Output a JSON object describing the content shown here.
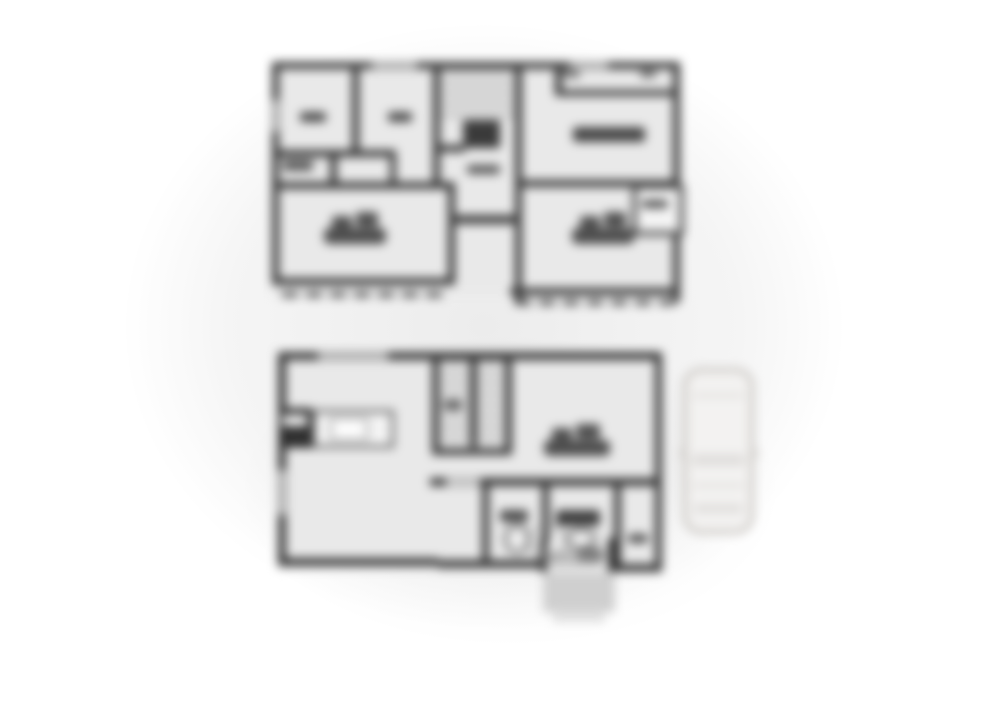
{
  "canvas": {
    "width": 1000,
    "height": 709,
    "description": "Heavily blurred monochrome two-storey house floor plan with a car parked beside the ground floor"
  },
  "colors": {
    "page_bg": "#ffffff",
    "backdrop_gray": "#ebebeb",
    "wall": "#333333",
    "room_fill": "#e9e9e9",
    "furniture": "#4a4a4a",
    "window": "#c4c4c4",
    "porch": "#cfcfcf",
    "car_outline": "#c4c0bb",
    "car_fill": "#f3f2f1"
  },
  "upper_floor": {
    "name": "upper floor plan",
    "features": [
      "small room with closet marker (top-left)",
      "small room with closet marker",
      "stairwell with landing",
      "central hall",
      "bedroom left with double bed",
      "bedroom right with double bed",
      "closet (right)",
      "balcony rails along bottom edge"
    ]
  },
  "lower_floor": {
    "name": "lower floor plan",
    "features": [
      "kitchen counter with sink and stove",
      "staircase",
      "living room with double bed",
      "toilet room",
      "washroom with basin",
      "side room",
      "entrance with step and porch"
    ]
  },
  "vehicle": {
    "name": "car seen from above",
    "location": "parked right of lower floor plan"
  },
  "blur": {
    "radius_px": 5
  }
}
